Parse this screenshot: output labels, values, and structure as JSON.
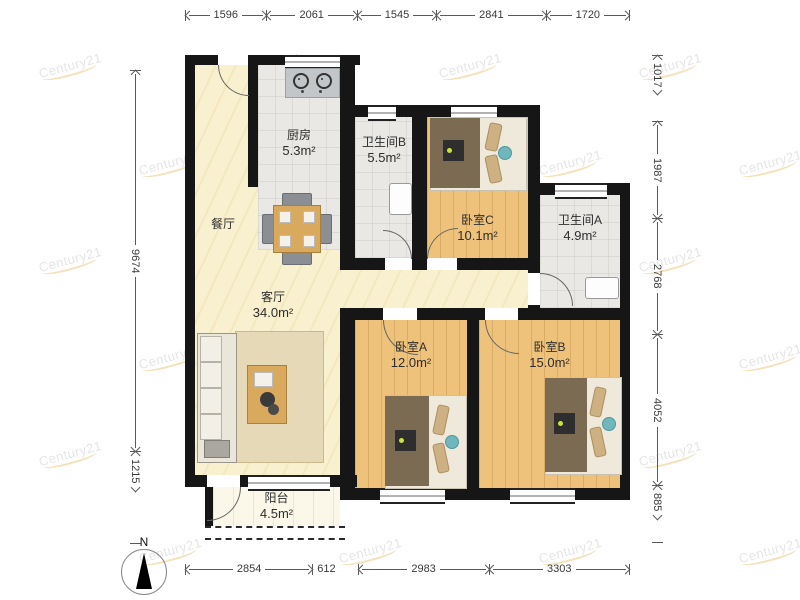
{
  "watermark": {
    "text": "Century21"
  },
  "compass": {
    "label": "N"
  },
  "dimensions": {
    "top": [
      "1596",
      "2061",
      "1545",
      "2841",
      "1720"
    ],
    "bottom": [
      "2854",
      "612",
      "2983",
      "3303"
    ],
    "left": [
      "9674",
      "1215"
    ],
    "right": [
      "1017",
      "1987",
      "2768",
      "4052",
      "885"
    ]
  },
  "rooms": {
    "kitchen": {
      "name": "厨房",
      "area": "5.3m²"
    },
    "dining": {
      "name": "餐厅"
    },
    "living": {
      "name": "客厅",
      "area": "34.0m²"
    },
    "bathB": {
      "name": "卫生间B",
      "area": "5.5m²"
    },
    "bedC": {
      "name": "卧室C",
      "area": "10.1m²"
    },
    "bathA": {
      "name": "卫生间A",
      "area": "4.9m²"
    },
    "bedA": {
      "name": "卧室A",
      "area": "12.0m²"
    },
    "bedB": {
      "name": "卧室B",
      "area": "15.0m²"
    },
    "balcony": {
      "name": "阳台",
      "area": "4.5m²"
    }
  },
  "colors": {
    "wall": "#161616",
    "living_floor": "#f8f0cf",
    "wood_floor": "#eec27b",
    "tile_floor": "#e9e8e4",
    "accent_gold": "#eccf8e"
  }
}
